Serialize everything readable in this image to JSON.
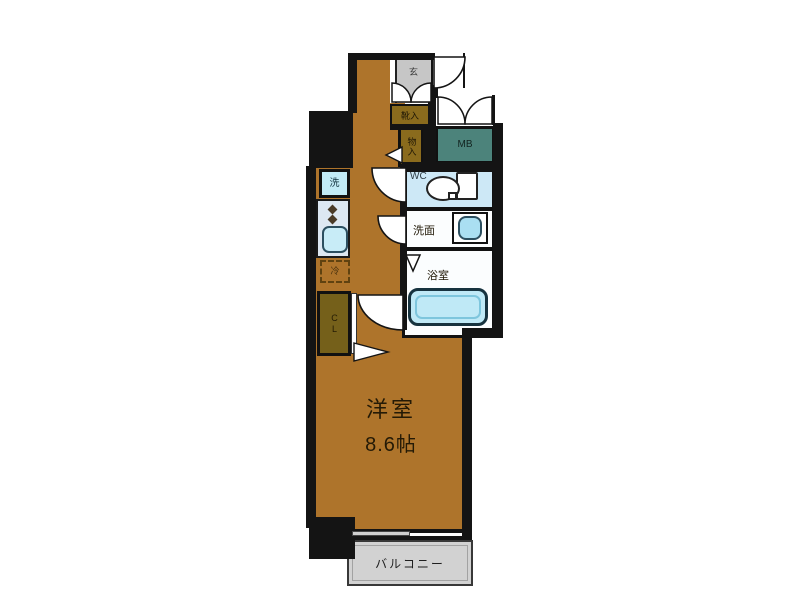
{
  "plan_title": "one-room apartment floor plan",
  "palette": {
    "wall": "#141414",
    "floor_brown": "#ae742b",
    "storage_olive": "#8a6b1d",
    "closet_olive": "#75601a",
    "meter_box_teal": "#4c837b",
    "entrance_gray": "#c6c6c6",
    "balcony_gray": "#d2d2d2",
    "wc_blue": "#cde8f6",
    "fixture_blue": "#c2ebf6",
    "counter_blue": "#dde8f2",
    "tub_blue": "#bfe9f6"
  },
  "rooms": {
    "entrance": {
      "label": "玄"
    },
    "shoe_cabinet": {
      "label": "靴入"
    },
    "storage": {
      "label": "物入"
    },
    "meter_box": {
      "label": "MB"
    },
    "toilet": {
      "label": "WC"
    },
    "washroom": {
      "label": "洗面"
    },
    "bathroom": {
      "label": "浴室"
    },
    "kitchen": {
      "washer_label": "洗",
      "fridge_label": "冷"
    },
    "closet": {
      "label": "CL"
    },
    "main_room": {
      "name": "洋室",
      "size": "8.6帖"
    },
    "balcony": {
      "label": "バルコニー"
    }
  }
}
